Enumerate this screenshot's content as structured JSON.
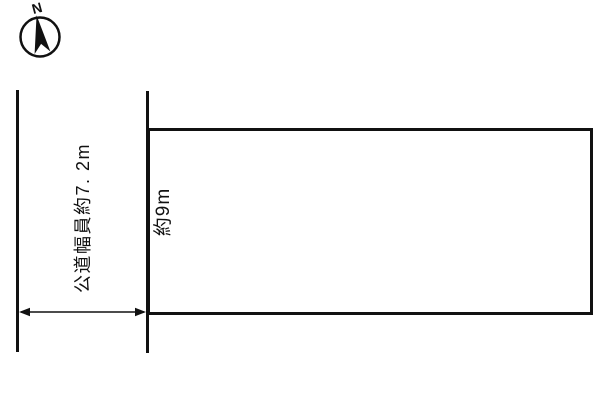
{
  "page": {
    "background_color": "#ffffff",
    "line_color": "#111111",
    "type": "land-plot-site-diagram"
  },
  "compass": {
    "label": "N"
  },
  "labels": {
    "road_width": "公道幅員約7. 2m",
    "frontage": "約9m"
  }
}
